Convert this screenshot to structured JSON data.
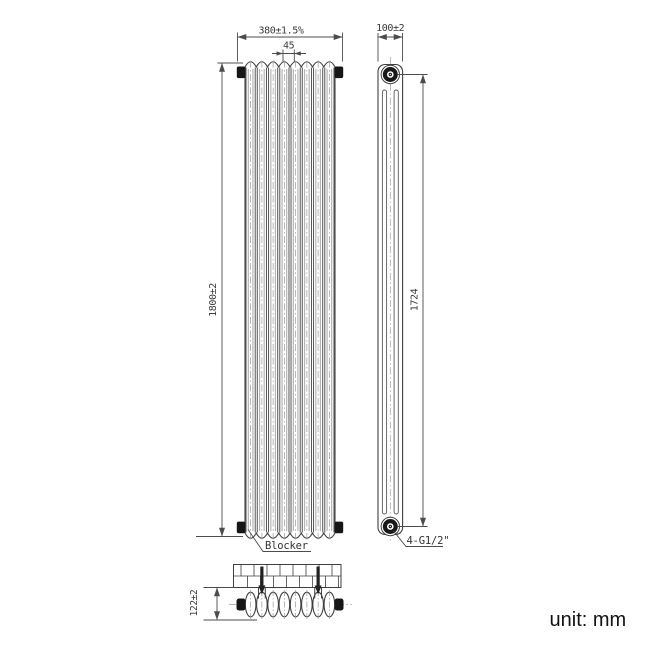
{
  "drawing": {
    "unit_note": "unit: mm",
    "front_view": {
      "columns": 8,
      "overall_width_dim": "380±1.5%",
      "column_pitch_dim": "45",
      "overall_height_dim": "1800±2",
      "blocker_label": "Blocker"
    },
    "side_view": {
      "depth_dim": "100±2",
      "port_distance_dim": "1724",
      "connection_label": "4-G1/2\""
    },
    "installation_view": {
      "wall_distance_dim": "122±2"
    },
    "colors": {
      "line": "#3f3f3f",
      "dim": "#4c4c4c",
      "centerline": "#9a9a9a",
      "cap": "#161616",
      "text": "#333333",
      "background": "#ffffff"
    }
  }
}
